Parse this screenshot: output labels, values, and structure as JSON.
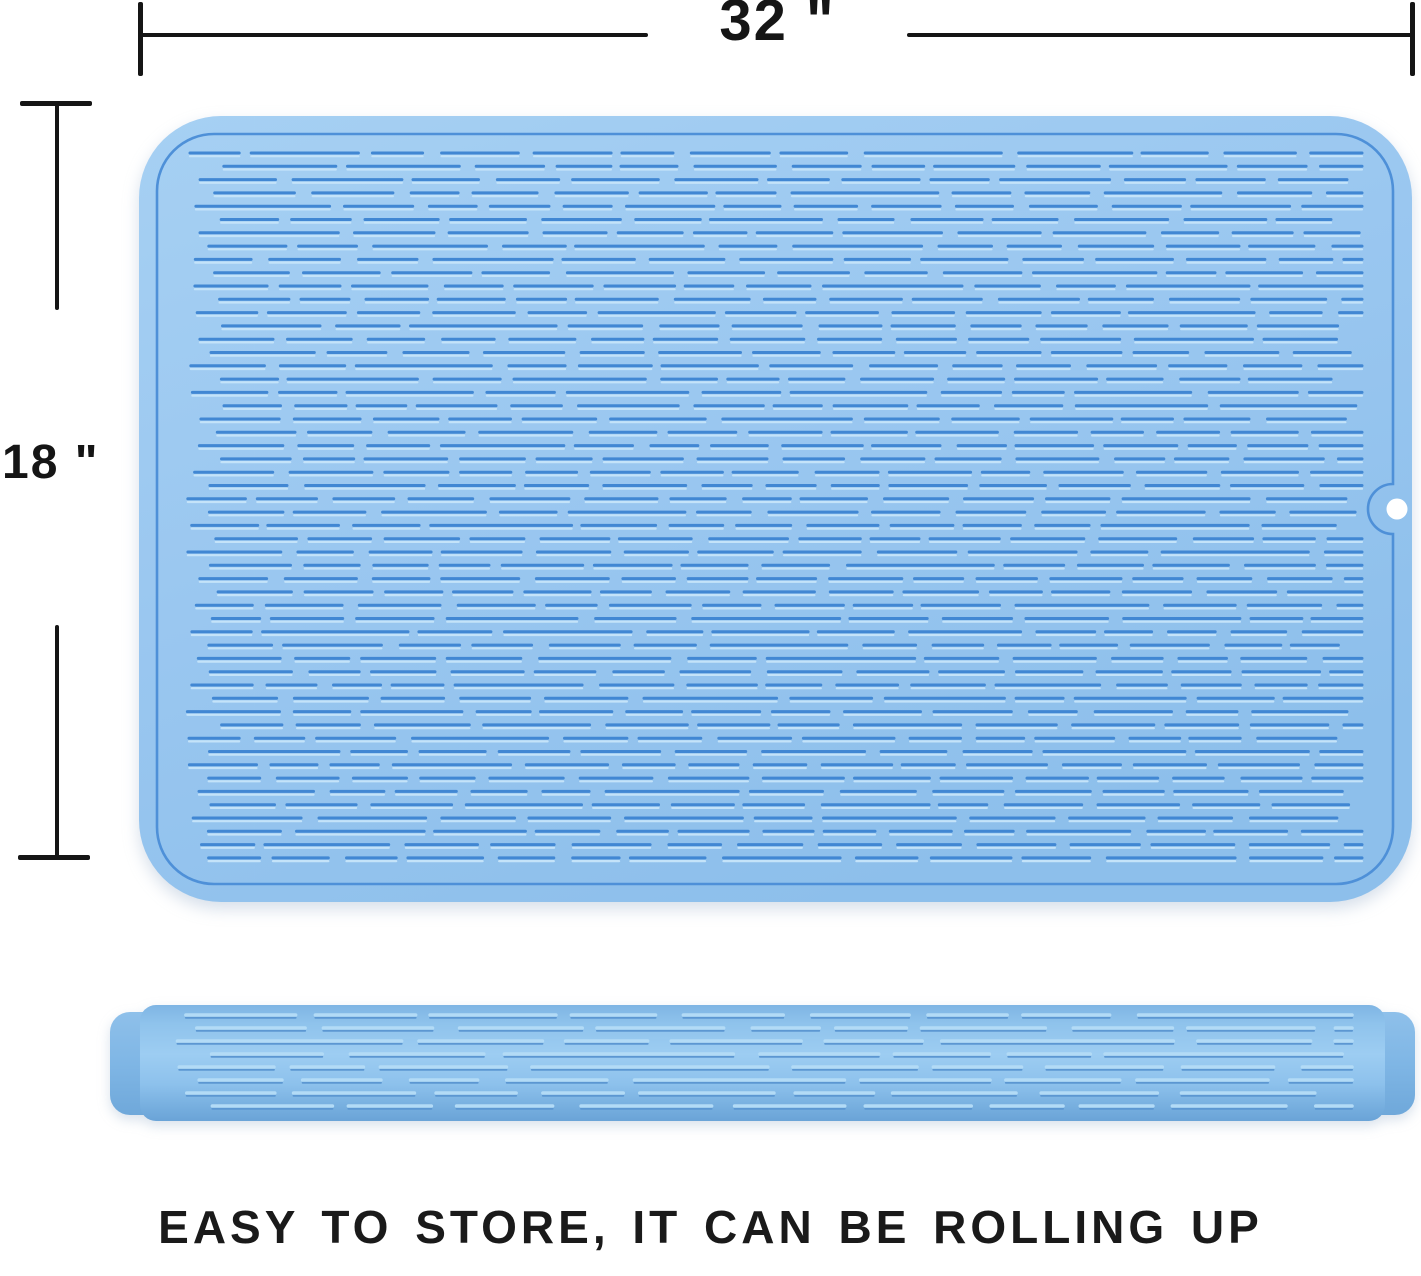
{
  "annotations": {
    "width_label": "32 \"",
    "height_label": "18 \""
  },
  "caption": "EASY TO STORE, IT CAN BE ROLLING UP",
  "colors": {
    "annotation_ink": "#151515",
    "caption_ink": "#1a1a1a",
    "mat_body": "#9AC7F0",
    "mat_groove": "#4187D3",
    "mat_groove_highlight": "#C4E3F9",
    "mat_rim_line": "#4E90D8",
    "hang_hole": "#FFFFFF",
    "roll_body": "#8FC3EC",
    "roll_ridge": "#B3DBF6",
    "roll_ridge_shadow": "#5C97D2",
    "roll_cap": "#7FB6E5"
  }
}
